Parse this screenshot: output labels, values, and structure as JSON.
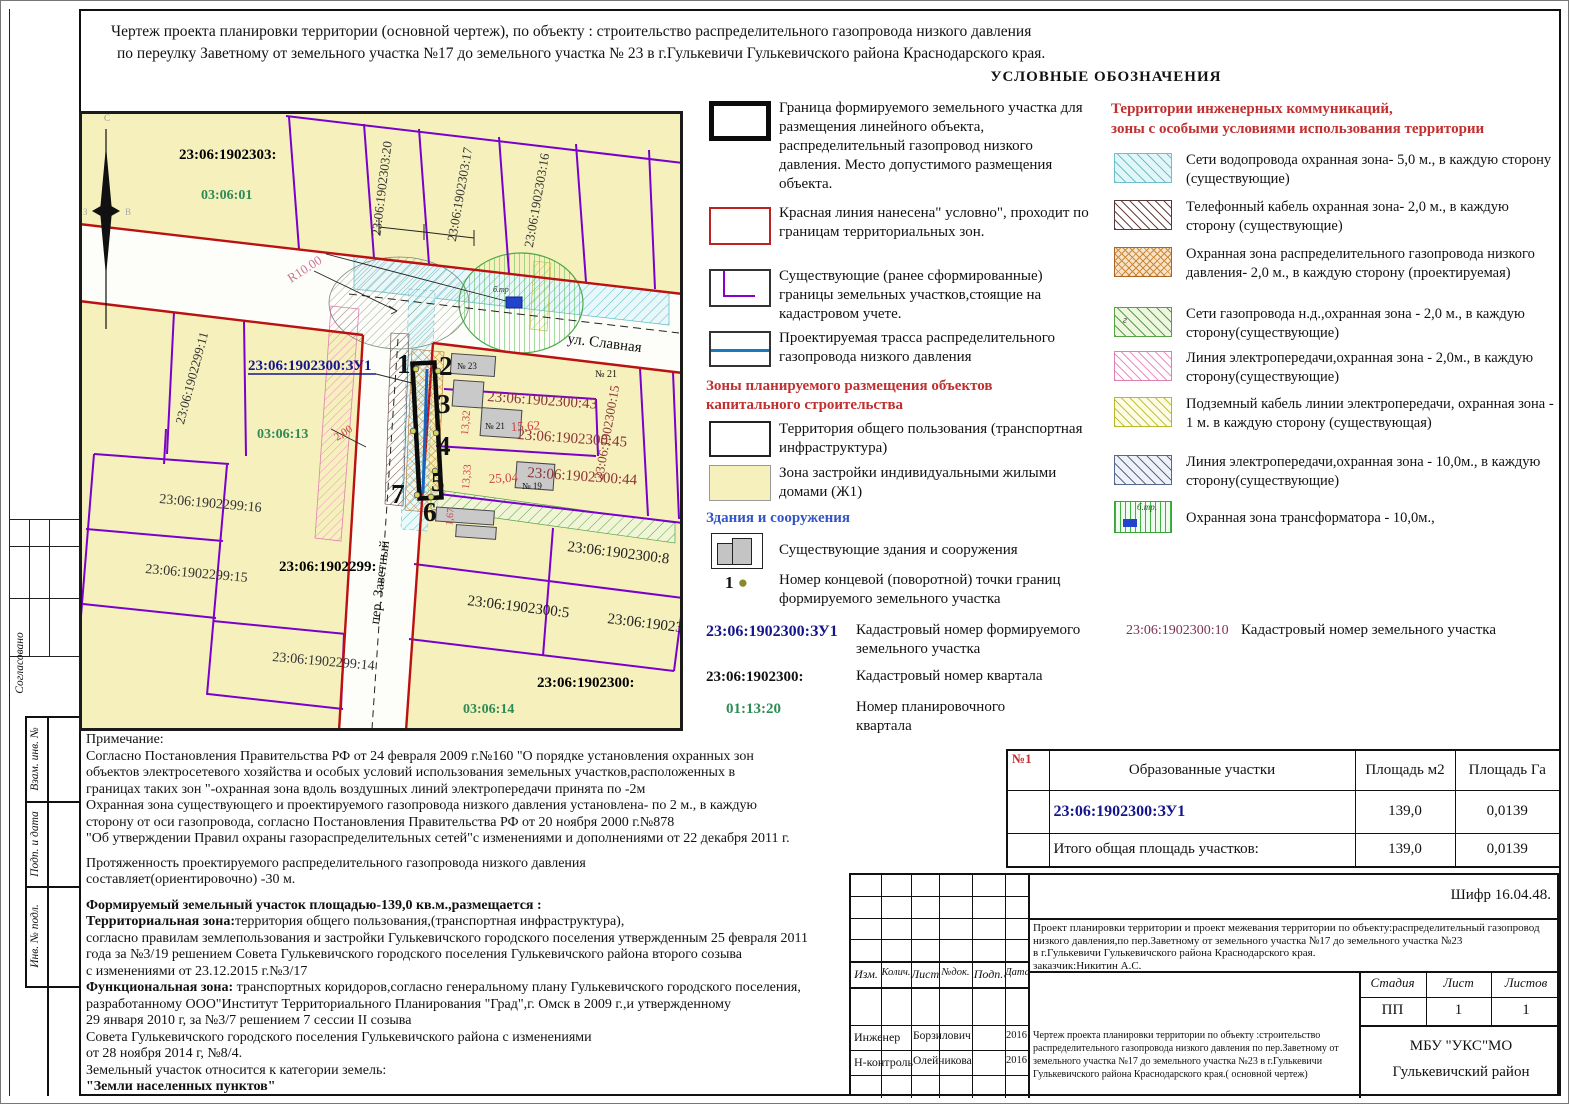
{
  "header": {
    "line1": "Чертеж проекта планировки территории (основной чертеж), по объекту :  строительство распределительного газопровода низкого давления",
    "line2": "по переулку Заветному от земельного участка №17 до земельного участка № 23 в  г.Гулькевичи Гулькевичского района Краснодарского края.",
    "legend_title": "УСЛОВНЫЕ ОБОЗНАЧЕНИЯ"
  },
  "frame_labels": [
    "Согласовано",
    "Взам. инв. №",
    "Подп. и дата",
    "Инв. № подл."
  ],
  "map": {
    "labels": {
      "quarter2303": "23:06:1902303:",
      "plan0301": "03:06:01",
      "v230320": "23:06:1902303:20",
      "v230317": "23:06:1902303:17",
      "v230316": "23:06:1902303:16",
      "v229911": "23:06:1902299:11",
      "zu1": "23:06:1902300:ЗУ1",
      "plan0313": "03:06:13",
      "r10": "R10.00",
      "dim200": "2,00",
      "ul_slavnaya": "ул. Славная",
      "per_zavetny": "пер. Заветный",
      "house23": "№ 23",
      "house21": "№ 21",
      "house19": "№ 19",
      "house_east": "№ 21",
      "c43": "23:06:1902300:43",
      "c45": "23:06:1902300:45",
      "c44": "23:06:1902300:44",
      "v2300_15": "23:06:1902300:15",
      "c8": "23:06:1902300:8",
      "c5": "23:06:1902300:5",
      "c10": "23:06:1902300:10",
      "quarter2300": "23:06:1902300:",
      "plan0314": "03:06:14",
      "c2299_16": "23:06:1902299:16",
      "c2299_15": "23:06:1902299:15",
      "quarter2299": "23:06:1902299:",
      "c2299_14": "23:06:1902299:14",
      "d1332": "13,32",
      "d1333": "13,33",
      "d2504": "25,04",
      "d1562": "15,62",
      "d167": "1,67",
      "p1": "1",
      "p2": "2",
      "p3": "3",
      "p4": "4",
      "p5": "5",
      "p6": "6",
      "p7": "7",
      "btr": "б.тр",
      "n_c": "С",
      "n_w": "З",
      "n_e": "В"
    }
  },
  "legend_left": {
    "items": [
      {
        "text": "Граница формируемого земельного участка для размещения линейного объекта, распределительный газопровод низкого давления. Место допустимого размещения объекта."
      },
      {
        "text": "Красная линия  нанесена\" условно\", проходит по границам территориальных зон."
      },
      {
        "text": "Существующие (ранее сформированные) границы земельных участков,стоящие на кадастровом учете."
      },
      {
        "text": "Проектируемая трасса распределительного газопровода низкого давления"
      }
    ],
    "zones_heading": "Зоны планируемого размещения объектов капитального строительства",
    "zone_items": [
      {
        "text": "Территория общего пользования (транспортная инфраструктура)"
      },
      {
        "text": "Зона застройки индивидуальными жилыми домами (Ж1)"
      }
    ],
    "buildings_heading": "Здания и сооружения",
    "buildings_text": "Существующие здания и сооружения",
    "point_num": "1",
    "point_text": "Номер концевой (поворотной) точки границ формируемого земельного участка",
    "cad_formed_code": "23:06:1902300:ЗУ1",
    "cad_formed_text": "Кадастровый номер формируемого земельного участка",
    "cad_plot_code": "23:06:1902300:10",
    "cad_plot_text": "Кадастровый номер земельного участка",
    "cad_quarter_code": "23:06:1902300:",
    "cad_quarter_text": "Кадастровый номер квартала",
    "plan_quarter_code": "01:13:20",
    "plan_quarter_text": "Номер планировочного квартала"
  },
  "legend_right": {
    "heading1": "Территории инженерных коммуникаций,",
    "heading2": "зоны с особыми условиями использования территории",
    "items": [
      {
        "text": "Сети водопровода охранная зона- 5,0 м., в каждую сторону (существующие)",
        "mark": ""
      },
      {
        "text": "Телефонный кабель охранная зона- 2,0 м., в каждую сторону (существующие)",
        "mark": ""
      },
      {
        "text": "Охранная зона распределительного газопровода низкого давления- 2,0 м., в каждую сторону (проектируемая)",
        "mark": ""
      },
      {
        "text": "Сети газопровода н.д.,охранная зона - 2,0 м., в каждую сторону(существующие)",
        "mark": "г"
      },
      {
        "text": "Линия электропередачи,охранная зона - 2,0м., в каждую сторону(существующие)",
        "mark": ""
      },
      {
        "text": "Подземный кабель линии электропередачи, охранная зона - 1 м. в каждую сторону (существующая)",
        "mark": ""
      },
      {
        "text": "Линия электропередачи,охранная зона - 10,0м., в каждую сторону(существующие)",
        "mark": ""
      },
      {
        "text": "Охранная зона трансформатора  - 10,0м.,",
        "mark": "б.тр."
      }
    ]
  },
  "notes": {
    "head": "Примечание:",
    "p1": [
      "Согласно Постановления Правительства РФ от 24 февраля 2009 г.№160 \"О порядке установления  охранных зон",
      "объектов электросетевого хозяйства и особых условий использования земельных участков,расположенных в",
      "границах таких зон \"-охранная зона вдоль воздушных линий электропередачи принята по -2м",
      "Охранная зона существующего и проектируемого газопровода низкого  давления установлена- по 2 м., в каждую",
      "сторону от оси газопровода, согласно Постановления Правительства  РФ от 20 ноября 2000 г.№878",
      "\"Об утверждении Правил охраны газораспределительных сетей\"с изменениями и дополнениями от 22 декабря 2011 г."
    ],
    "p2": [
      "Протяженность проектируемого распределительного газопровода низкого давления",
      "составляет(ориентировочно) -30 м."
    ],
    "formed": "Формируемый земельный участок площадью-139,0 кв.м.,размещается :",
    "tz_label": "Территориальная зона:",
    "tz_text": "территория общего пользования,(транспортная инфраструктура),",
    "p3": [
      "согласно правилам землепользования и застройки Гулькевичского городского поселения утвержденным 25 февраля 2011",
      " года за №3/19 решением Совета Гулькевичского городского поселения Гулькевичского района второго созыва",
      "с изменениями от 23.12.2015 г.№3/17"
    ],
    "fz_label": "Функциональная зона:",
    "fz_text": " транспортных коридоров,согласно генеральному плану Гулькевичского городского поселения,",
    "p4": [
      "разработанному ООО\"Институт Территориального Планирования \"Град\",г. Омск в 2009 г.,и утвержденному",
      "29 января 2010 г, за №3/7 решением 7 сессии II созыва",
      " Совета Гулькевичского городского поселения Гулькевичского района с изменениями",
      " от 28 ноября 2014 г, №8/4.",
      "Земельный участок относится к категории земель:"
    ],
    "category": "\"Земли населенных пунктов\""
  },
  "table": {
    "col_num": "№1",
    "col_name": "Образованные участки",
    "col_m2": "Площадь м2",
    "col_ga": "Площадь Га",
    "row1_name": "23:06:1902300:ЗУ1",
    "row1_m2": "139,0",
    "row1_ga": "0,0139",
    "row2_name": "Итого общая площадь участков:",
    "row2_m2": "139,0",
    "row2_ga": "0,0139"
  },
  "stamp": {
    "shifr": "Шифр 16.04.48.",
    "project_lines": [
      "Проект планировки территории и проект межевания  территории по объекту:распределительный газопровод",
      "низкого давления,по пер.Заветному от земельного участка №17 до земельного участка №23",
      "в г.Гулькевичи Гулькевичского района Краснодарского края.",
      "заказчик:Никитин А.С."
    ],
    "cols": [
      "Изм.",
      "Колич.",
      "Лист",
      "№док.",
      "Подп.",
      "Дата"
    ],
    "stage_h": [
      "Стадия",
      "Лист",
      "Листов"
    ],
    "stage_v": [
      "ПП",
      "1",
      "1"
    ],
    "roles": [
      {
        "role": "Инженер",
        "name": "Борзилович",
        "date": "2016"
      },
      {
        "role": "Н-контроль",
        "name": "Олейникова",
        "date": "2016"
      }
    ],
    "title_lines": [
      "Чертеж проекта планировки территории по объекту :строительство",
      "распределительного газопровода низкого давления по пер.Заветному от",
      "земельного участка №17 до земельного участка №23 в г.Гулькевичи",
      "Гулькевичского района Краснодарского края.( основной чертеж)"
    ],
    "org1": "МБУ \"УКС\"МО",
    "org2": "Гулькевичский район"
  }
}
